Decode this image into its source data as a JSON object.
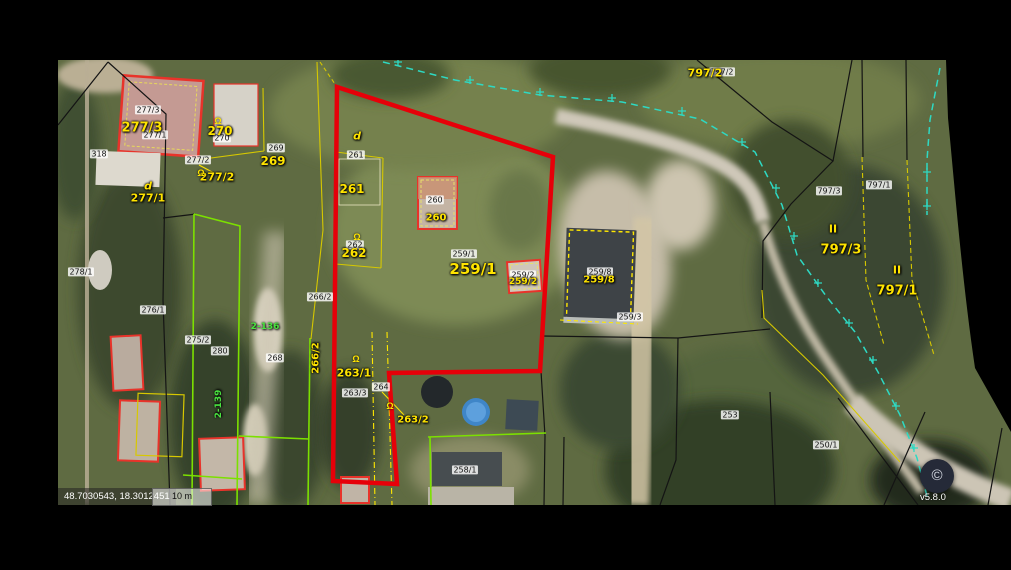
{
  "app": {
    "version": "v5.8.0",
    "copyright_symbol": "©",
    "coordinates": "48.7030543, 18.3012451",
    "scale_label": "10 m"
  },
  "colors": {
    "selection_outline": "#e60009",
    "parcel_label": "#ffe400",
    "badge_background": "#ffffff",
    "lime_boundary": "#7ce000",
    "yellow_boundary": "#d6c800",
    "teal_utility_line": "#2ed9c3",
    "green_road_label": "#49e43f"
  },
  "map": {
    "badges": [
      {
        "text": "318",
        "x": 99,
        "y": 154
      },
      {
        "text": "277/3",
        "x": 148,
        "y": 110
      },
      {
        "text": "277/1",
        "x": 155,
        "y": 135
      },
      {
        "text": "270",
        "x": 222,
        "y": 138
      },
      {
        "text": "277/2",
        "x": 198,
        "y": 160
      },
      {
        "text": "269",
        "x": 276,
        "y": 148
      },
      {
        "text": "278/1",
        "x": 81,
        "y": 272
      },
      {
        "text": "276/1",
        "x": 153,
        "y": 310
      },
      {
        "text": "275/2",
        "x": 198,
        "y": 340
      },
      {
        "text": "280",
        "x": 220,
        "y": 351
      },
      {
        "text": "268",
        "x": 275,
        "y": 358
      },
      {
        "text": "266/2",
        "x": 320,
        "y": 297
      },
      {
        "text": "261",
        "x": 356,
        "y": 155
      },
      {
        "text": "262",
        "x": 355,
        "y": 245
      },
      {
        "text": "260",
        "x": 435,
        "y": 200
      },
      {
        "text": "259/1",
        "x": 464,
        "y": 254
      },
      {
        "text": "259/2",
        "x": 523,
        "y": 275
      },
      {
        "text": "259/8",
        "x": 600,
        "y": 272
      },
      {
        "text": "259/3",
        "x": 630,
        "y": 317
      },
      {
        "text": "263/3",
        "x": 355,
        "y": 393
      },
      {
        "text": "264",
        "x": 381,
        "y": 387
      },
      {
        "text": "253",
        "x": 730,
        "y": 415
      },
      {
        "text": "250/1",
        "x": 826,
        "y": 445
      },
      {
        "text": "258/1",
        "x": 465,
        "y": 470
      },
      {
        "text": "797/2",
        "x": 722,
        "y": 72
      },
      {
        "text": "797/3",
        "x": 829,
        "y": 191
      },
      {
        "text": "797/1",
        "x": 879,
        "y": 185
      }
    ],
    "parcel_labels": [
      {
        "text": "277/3",
        "x": 142,
        "y": 128,
        "size": 13
      },
      {
        "text": "270",
        "x": 220,
        "y": 131,
        "size": 12
      },
      {
        "text": "269",
        "x": 273,
        "y": 161,
        "size": 12
      },
      {
        "text": "277/2",
        "x": 217,
        "y": 177,
        "size": 11
      },
      {
        "text": "d",
        "x": 148,
        "y": 186,
        "size": 11,
        "italic": true
      },
      {
        "text": "277/1",
        "x": 148,
        "y": 198,
        "size": 11
      },
      {
        "text": "d",
        "x": 357,
        "y": 136,
        "size": 11,
        "italic": true
      },
      {
        "text": "261",
        "x": 352,
        "y": 189,
        "size": 12
      },
      {
        "text": "262",
        "x": 354,
        "y": 253,
        "size": 12
      },
      {
        "text": "260",
        "x": 436,
        "y": 218,
        "size": 10
      },
      {
        "text": "259/1",
        "x": 473,
        "y": 269,
        "size": 15
      },
      {
        "text": "259/2",
        "x": 523,
        "y": 282,
        "size": 9
      },
      {
        "text": "259/8",
        "x": 599,
        "y": 280,
        "size": 10
      },
      {
        "text": "263/1",
        "x": 354,
        "y": 373,
        "size": 11
      },
      {
        "text": "263/2",
        "x": 413,
        "y": 420,
        "size": 10
      },
      {
        "text": "266/2",
        "x": 316,
        "y": 358,
        "size": 10,
        "rot": -90
      },
      {
        "text": "797/2",
        "x": 705,
        "y": 73,
        "size": 11
      },
      {
        "text": "II",
        "x": 833,
        "y": 229,
        "size": 11
      },
      {
        "text": "797/3",
        "x": 841,
        "y": 250,
        "size": 13
      },
      {
        "text": "II",
        "x": 897,
        "y": 270,
        "size": 11
      },
      {
        "text": "797/1",
        "x": 897,
        "y": 291,
        "size": 13
      }
    ],
    "green_labels": [
      {
        "text": "2-136",
        "x": 265,
        "y": 327,
        "size": 9
      },
      {
        "text": "2-139",
        "x": 219,
        "y": 404,
        "size": 9,
        "rot": -90
      }
    ],
    "symbols": [
      {
        "glyph": "Ω",
        "x": 218,
        "y": 121
      },
      {
        "glyph": "Ω",
        "x": 201,
        "y": 173
      },
      {
        "glyph": "Ω",
        "x": 357,
        "y": 237
      },
      {
        "glyph": "Ω",
        "x": 356,
        "y": 359
      },
      {
        "glyph": "Ω",
        "x": 390,
        "y": 406
      }
    ]
  }
}
